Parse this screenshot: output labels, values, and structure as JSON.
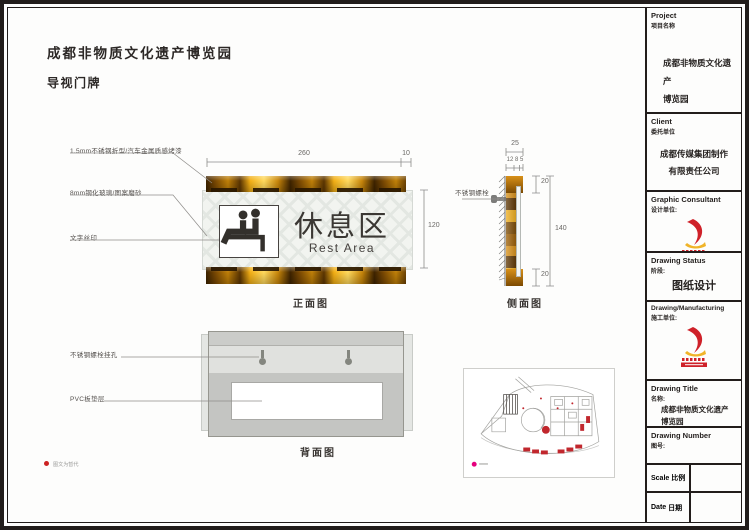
{
  "doc": {
    "title_line1": "成都非物质文化遗产博览园",
    "title_line2": "导视门牌"
  },
  "sign": {
    "zh": "休息区",
    "en": "Rest Area",
    "icon": "rest-area-seated-people-icon"
  },
  "views": {
    "front": "正面图",
    "side": "侧面图",
    "back": "背面图"
  },
  "annotations": {
    "front": [
      {
        "label": "1.5mm不锈钢折型/汽车金属质感烤漆"
      },
      {
        "label": "8mm钢化玻璃/图案磨砂"
      },
      {
        "label": "文字丝印"
      }
    ],
    "side_bolt": "不锈钢螺栓",
    "back": [
      {
        "label": "不锈钢螺栓挂孔"
      },
      {
        "label": "PVC板垫层"
      }
    ],
    "footnote": "图文为暂代"
  },
  "dimensions": {
    "front_width": "260",
    "front_edge": "10",
    "front_height": "120",
    "side_width": "25",
    "side_layers": "12 8 5",
    "side_top": "20",
    "side_height": "140",
    "side_bottom": "20"
  },
  "titleblock": {
    "project": {
      "en": "Project",
      "zh": "项目名称",
      "line1": "成都非物质文化遗产",
      "line2": "博览园"
    },
    "client": {
      "en": "Client",
      "zh": "委托单位",
      "line1": "成都传媒集团制作",
      "line2": "有限责任公司"
    },
    "consultant": {
      "en": "Graphic Consultant",
      "zh": "设计单位:"
    },
    "status": {
      "en": "Drawing Status",
      "zh": "阶段:",
      "value": "图纸设计"
    },
    "manufacturing": {
      "en": "Drawing/Manufacturing",
      "zh": "施工单位:"
    },
    "drawing_title": {
      "en": "Drawing Title",
      "zh": "名称:",
      "line1": "成都非物质文化遗产",
      "line2": "博览园"
    },
    "drawing_number": {
      "en": "Drawing Number",
      "zh": "图号:",
      "value": ""
    },
    "scale": {
      "en": "Scale",
      "zh": "比例",
      "value": ""
    },
    "date": {
      "en": "Date",
      "zh": "日期",
      "value": ""
    }
  },
  "colors": {
    "gold_dark": "#3c2200",
    "gold_mid": "#c08008",
    "gold_bright": "#ffd95e",
    "panel_bg": "#f2f4f0",
    "frame_black": "#221d1b",
    "accent_red": "#c1272d",
    "legend_magenta": "#e5007d"
  }
}
